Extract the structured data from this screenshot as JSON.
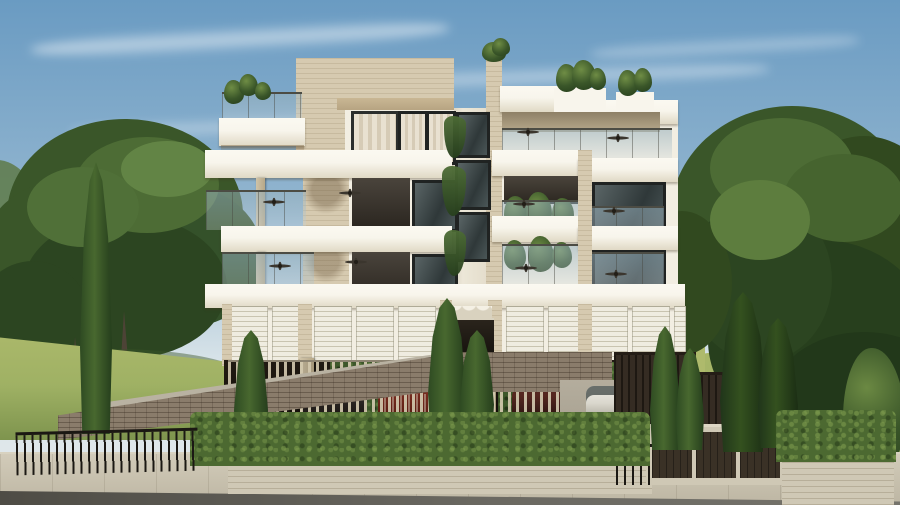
{
  "scene": {
    "type": "architectural-render",
    "description": "Photorealistic 3D exterior rendering of a modern four-storey apartment building with stacked white balcony slabs, glass railings, ceiling fans, rooftop planters, a louvered ground-floor screen and an open parking level with cars, framed by large leafy trees, lawns, slim cypress trees, a front hedge, black metal railings, a brick driveway ramp, street-level garage doors, a stone planter wall, a paved sidewalk and an asphalt road under a soft blue sky with wispy clouds.",
    "storeys_visible": 4,
    "parked_cars": [
      "dark-grey",
      "red",
      "maroon",
      "dark-brown",
      "white"
    ],
    "elements": [
      "sky",
      "clouds",
      "left-trees",
      "right-trees",
      "lawn",
      "apartment-building",
      "balconies",
      "glass-railings",
      "ceiling-fans",
      "roof-planters",
      "penthouse-windows",
      "louver-screens",
      "parking-level",
      "parked-cars",
      "entrance-canopy",
      "cypress-trees",
      "front-hedge",
      "metal-railings",
      "brick-ramp-wall",
      "driveway",
      "garage-doors",
      "planter-wall",
      "sidewalk",
      "road"
    ],
    "colors": {
      "sky_top": "#6a9bc2",
      "sky_mid": "#93b6d0",
      "sky_low": "#d9e4e9",
      "cloud": "rgba(255,255,255,0.55)",
      "tree_dark": "#273f1d",
      "tree_mid": "#3a5629",
      "tree_light": "#4d6c35",
      "tree_pale": "#5e7a48",
      "tree_highlight": "#6f8d45",
      "grass": "#9fb164",
      "grass_light": "#aeba6c",
      "grass_dark": "#7e944e",
      "facade": "#f2eee2",
      "slab": "#f8f5ec",
      "slab_shade": "#e0d9c5",
      "stone": "#d6cab0",
      "stone_shade": "#bfae8f",
      "soffit": "#c9b794",
      "glass_top": "#4c4c44",
      "win_frame": "#2b2e2d",
      "curtain_a": "#e9e1d1",
      "curtain_b": "#d6cbb6",
      "louver_bg": "#efece0",
      "louver_line": "#c9c4b0",
      "park_dark": "#221b13",
      "park_deep": "#120d08",
      "vine": "#42602e",
      "park_fence_slat": "rgba(208,198,172,0.92)",
      "dark_fence": "#352c23",
      "hedge": "#4c6931",
      "brick": "#8a7c6b",
      "wall_stone": "#cfc8b5",
      "sidewalk": "#c7c0ae",
      "road": "#6b6962",
      "road_dark": "#4e4c45",
      "bars": "#1b1813",
      "car_red": "#7d2b1e",
      "car_dark": "#282320",
      "car_maroon": "#46201b",
      "car_white": "#dad7cd",
      "car_glass": "#3f4645",
      "canopy": "#17130e",
      "paving": "#b4ad9d",
      "concrete": "#b9b2a2"
    }
  }
}
